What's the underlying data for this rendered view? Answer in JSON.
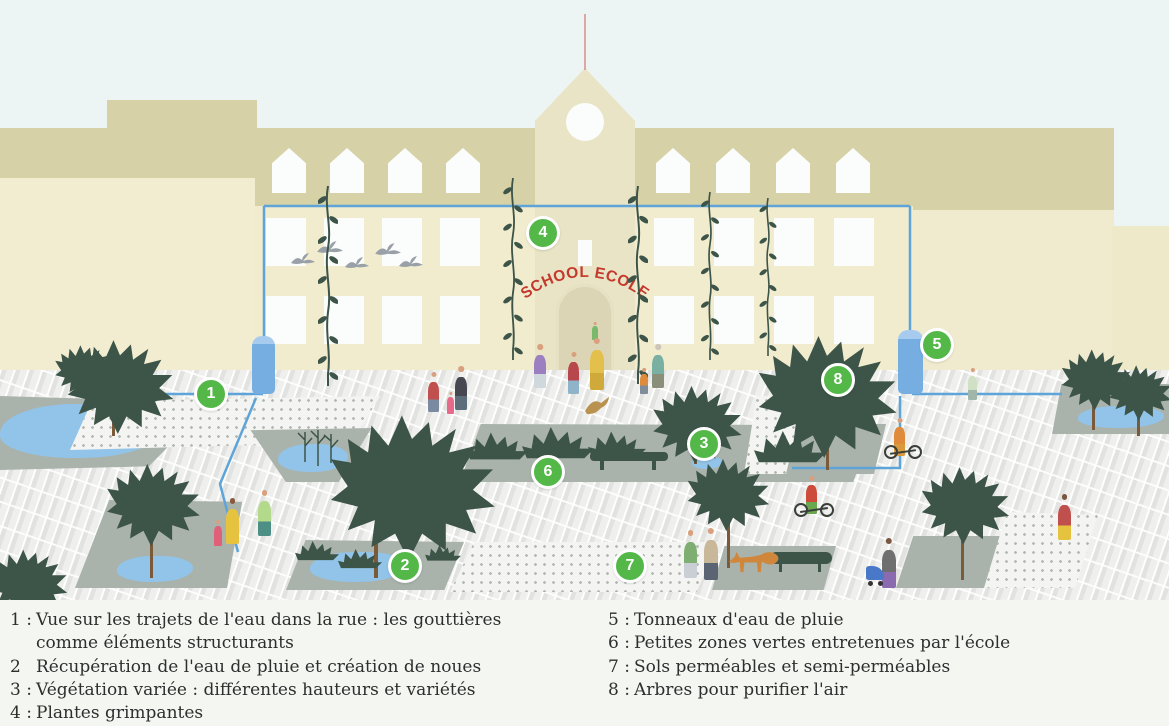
{
  "sign": {
    "text": "SCHOOL ECOLE"
  },
  "markers": [
    {
      "n": "1"
    },
    {
      "n": "2"
    },
    {
      "n": "3"
    },
    {
      "n": "4"
    },
    {
      "n": "5"
    },
    {
      "n": "6"
    },
    {
      "n": "7"
    },
    {
      "n": "8"
    }
  ],
  "legend": {
    "items": [
      {
        "num": "1 :",
        "text": "Vue sur les trajets de l'eau dans la rue : les gouttières comme éléments structurants"
      },
      {
        "num": "2",
        "text": "Récupération de l'eau de pluie et création de noues"
      },
      {
        "num": "3 :",
        "text": "Végétation variée : différentes hauteurs et variétés"
      },
      {
        "num": "4 :",
        "text": "Plantes grimpantes"
      },
      {
        "num": "5 :",
        "text": "Tonneaux d'eau de pluie"
      },
      {
        "num": "6 :",
        "text": "Petites zones vertes entretenues par l'école"
      },
      {
        "num": "7 :",
        "text": "Sols perméables et semi-perméables"
      },
      {
        "num": "8 :",
        "text": "Arbres pour purifier l'air"
      }
    ]
  },
  "colors": {
    "marker_green": "#54b848",
    "gutter_blue": "#5fa4d8",
    "sign_red": "#c4392d",
    "tree_green": "#3d5448",
    "water_blue": "#92c3e9"
  }
}
